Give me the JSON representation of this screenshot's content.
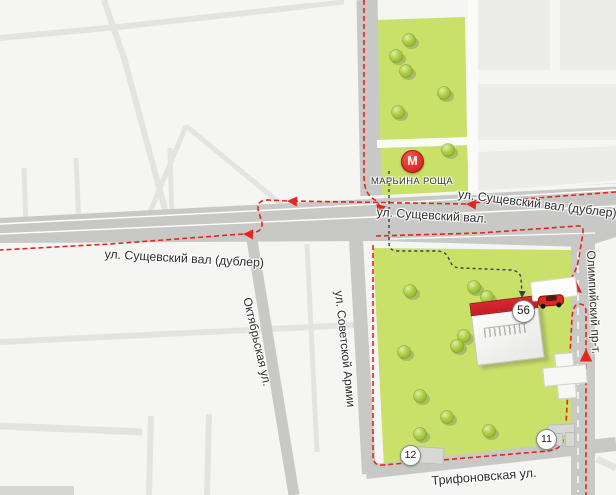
{
  "metro": {
    "symbol": "М",
    "station": "МАРЬИНА РОЩА"
  },
  "street_labels": {
    "sushchevsky_dubler_right": "ул. Сущевский вал (дублер)",
    "sushchevsky_val": "ул. Сущевский вал.",
    "sushchevsky_dubler_left": "ул. Сущевский вал (дублер)",
    "oktyabrskaya": "Октябрьская ул.",
    "sovetskoy_armii": "ул. Советской Армии",
    "olimpiysky": "Олимпийский пр-т.",
    "trifonovskaya": "Трифоновская ул."
  },
  "markers": {
    "destination_house": "56",
    "house_12": "12",
    "house_11": "11"
  },
  "colors": {
    "route_red": "#e2281c",
    "park_green": "#c9e168",
    "road_gray": "#c8c8c6",
    "road_minor": "#e3e3e1",
    "block_gray": "#ececea",
    "walk_dark": "#3d3d50",
    "metro_red": "#dc2f26",
    "building_red": "#c01e27",
    "bg": "#f5f5f3",
    "label_ink": "#2e2e2e"
  }
}
